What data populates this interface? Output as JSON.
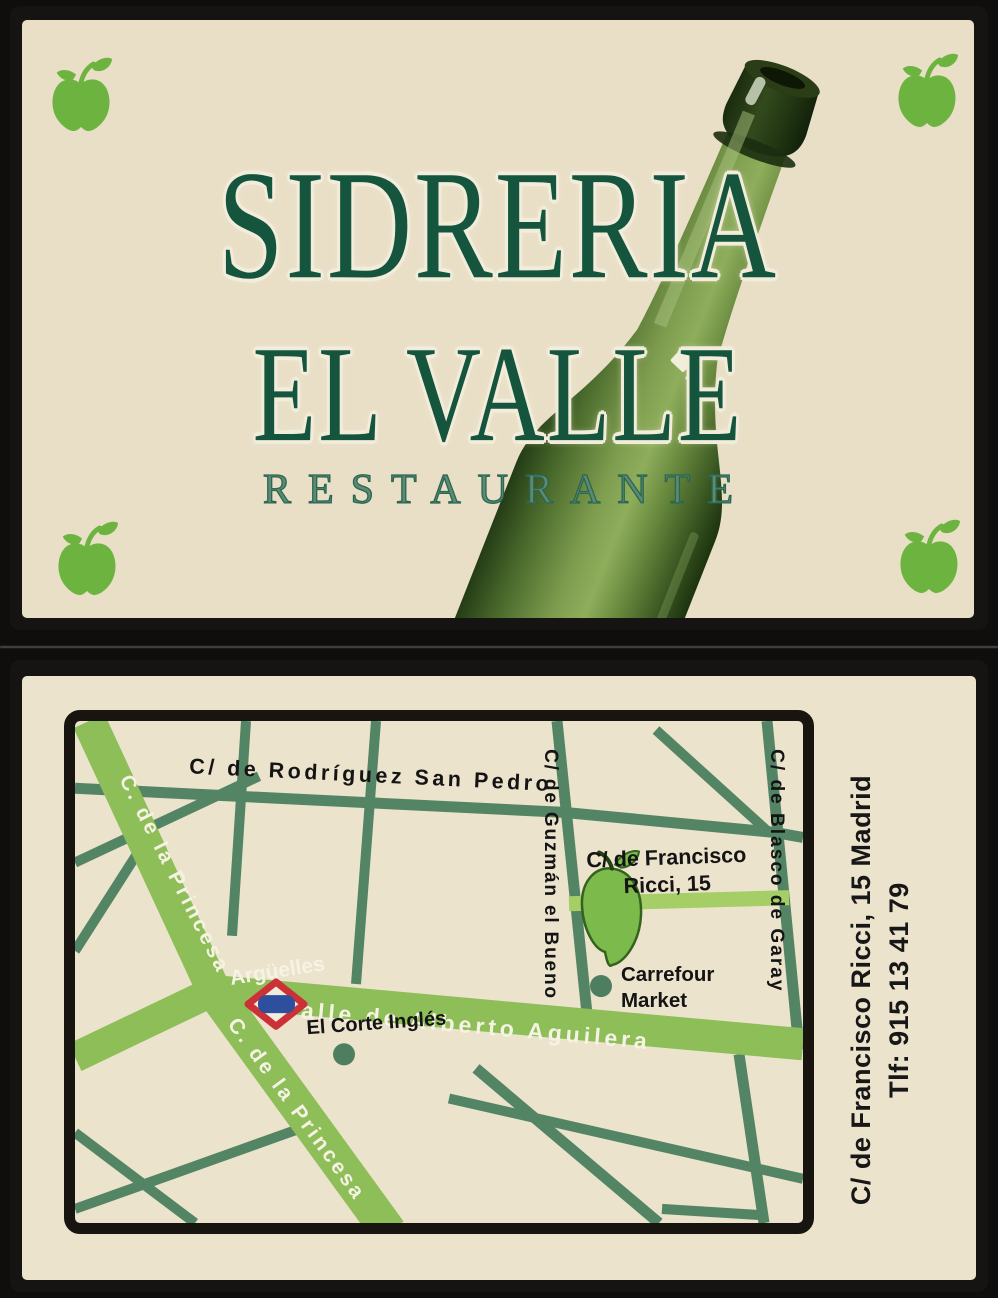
{
  "front": {
    "title_line1": "SIDRERIA",
    "title_line2": "EL VALLE",
    "subtitle": "RESTAURANTE"
  },
  "back": {
    "map": {
      "streets": {
        "rodriguez": "C/ de Rodríguez San Pedro",
        "princesa_upper": "C. de la Princesa",
        "princesa_lower": "C. de la Princesa",
        "guzman": "C/ de Guzmán el Bueno",
        "blasco": "C/ de Blasco de Garay",
        "aguilera": "Calle de Alberto Aguilera"
      },
      "metro_station": "Argüelles",
      "destination": {
        "line1": "C/ de Francisco",
        "line2": "Ricci, 15"
      },
      "pois": {
        "corte_ingles": "El Corte Inglés",
        "carrefour_line1": "Carrefour",
        "carrefour_line2": "Market"
      }
    },
    "contact": {
      "address": "C/ de Francisco Ricci, 15 Madrid",
      "phone": "Tlf: 915 13 41 79"
    }
  },
  "colors": {
    "card_background": "#e9dfc7",
    "title_green": "#15543d",
    "apple_green": "#6cb43f",
    "road_major": "#8dbe58",
    "road_destination": "#a6ce67",
    "street_minor": "#538565",
    "frame_black": "#18140f",
    "metro_red": "#cb3137",
    "metro_blue": "#2e4f9e"
  }
}
